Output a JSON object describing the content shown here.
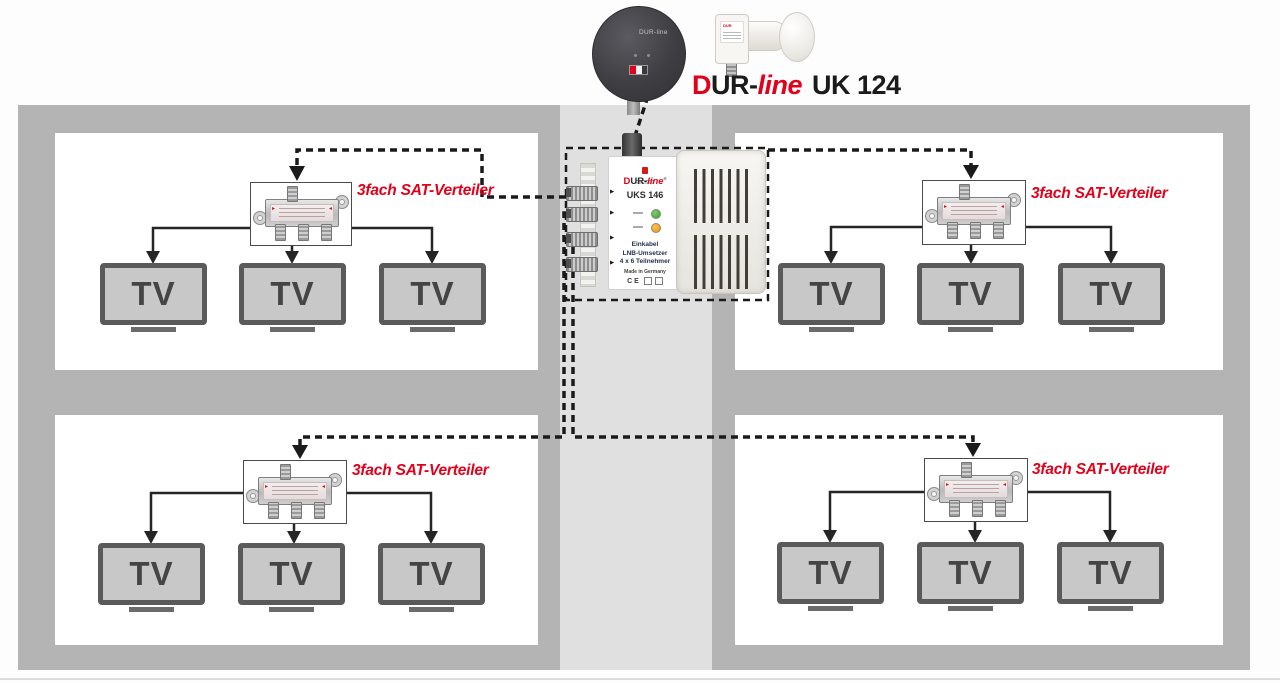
{
  "header": {
    "title_d": "D",
    "title_ur": "UR-",
    "title_line": "line",
    "title_model": "UK 124",
    "dish_logo": "DUR-line",
    "lnb_brand": "DUR"
  },
  "unit": {
    "brand_d": "D",
    "brand_ur": "UR-",
    "brand_line": "line",
    "brand_reg": "®",
    "model": "UKS 146",
    "desc_line1": "Einkabel",
    "desc_line2": "LNB-Umsetzer",
    "desc_line3": "4 x 6 Teilnehmer",
    "made_in": "Made in Germany",
    "ce_mark": "CE"
  },
  "rooms": [
    {
      "id": "top-left",
      "splitter_label": "3fach SAT-Verteiler",
      "tvs": [
        "TV",
        "TV",
        "TV"
      ]
    },
    {
      "id": "top-right",
      "splitter_label": "3fach SAT-Verteiler",
      "tvs": [
        "TV",
        "TV",
        "TV"
      ]
    },
    {
      "id": "bottom-left",
      "splitter_label": "3fach SAT-Verteiler",
      "tvs": [
        "TV",
        "TV",
        "TV"
      ]
    },
    {
      "id": "bottom-right",
      "splitter_label": "3fach SAT-Verteiler",
      "tvs": [
        "TV",
        "TV",
        "TV"
      ]
    }
  ],
  "colors": {
    "accent_red": "#e2001a",
    "wall_gray": "#b4b4b4",
    "column_gray": "#e0e0e0",
    "cable_black": "#1a1a1a",
    "tv_screen": "#c8c8c8",
    "tv_frame": "#5a5a5a",
    "led_green": "#2f9e27",
    "led_orange": "#ef9600"
  }
}
